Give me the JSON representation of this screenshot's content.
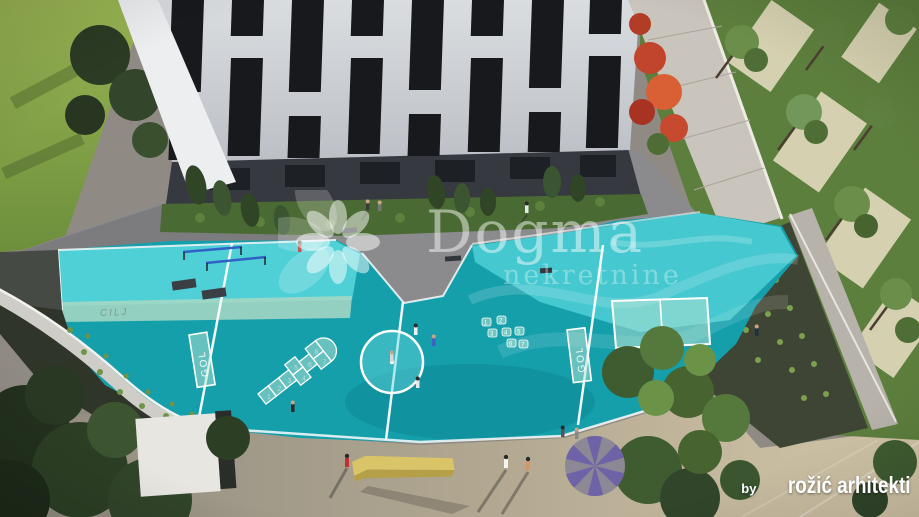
{
  "watermark": {
    "brand": "Dogma",
    "subtitle": "nekretnine",
    "logo_icon": "flower-pinwheel-logo"
  },
  "credit": {
    "prefix": "by",
    "studio": "rožić arhitekti"
  },
  "playground": {
    "finish_line_label": "CILJ",
    "goal_left_label": "GOL",
    "goal_right_label": "GOL",
    "hopscotch_numbers": [
      "1",
      "2",
      "3",
      "4",
      "5",
      "6",
      "7",
      "8"
    ],
    "number_game_dots": [
      "1",
      "2",
      "3",
      "4",
      "5",
      "6",
      "7"
    ],
    "surface_colors": {
      "light_turquoise": "#4ed0d6",
      "deep_teal": "#149fab",
      "marking_band": "#a9d8c4",
      "line_white": "#ffffff"
    }
  },
  "scene": {
    "description": "Aerial 3D architectural rendering: white residential building, teal playground court with football pitch markings, hopscotch, paths, lawns and trees",
    "palette": {
      "building_facade": "#cdd1d6",
      "window_dark": "#17191d",
      "lawn_green": "#86a845",
      "grass_green": "#5d7f3d",
      "pavement_grey": "#9b958a",
      "path_concrete": "#c9c4bc",
      "autumn_tree_red": "#c0452c",
      "pinwheel_purple": "#6f63a8",
      "slide_yellow": "#d9c467"
    }
  }
}
